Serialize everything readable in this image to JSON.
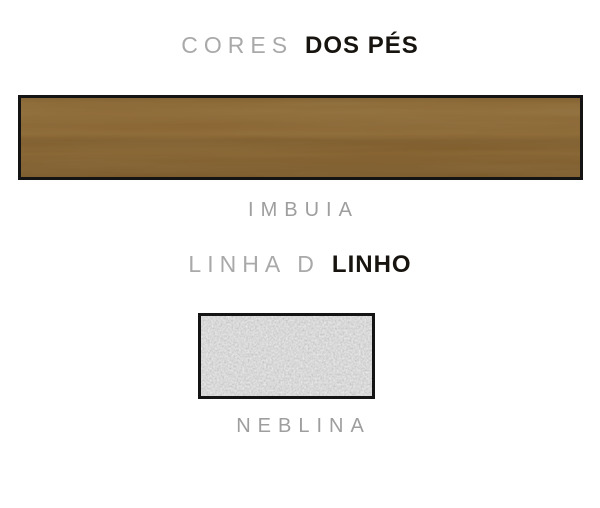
{
  "canvas": {
    "width": 600,
    "height": 508,
    "background": "#ffffff"
  },
  "colors": {
    "heading_light_text": "#a9a9a9",
    "heading_bold_text": "#17140f",
    "label_text": "#9e9e9e",
    "swatch_border": "#141414",
    "wood_base": "#87632f",
    "wood_light_band": "#8f6c39",
    "wood_dark_band": "#7a5728",
    "fabric_base": "#a9a9a9"
  },
  "sections": [
    {
      "heading": {
        "light": "CORES",
        "bold": "DOS PÉS"
      },
      "swatch": {
        "material": "wood",
        "label": "IMBUIA"
      }
    },
    {
      "heading": {
        "light": "LINHA D",
        "bold": "LINHO"
      },
      "swatch": {
        "material": "fabric",
        "label": "NEBLINA"
      }
    }
  ]
}
